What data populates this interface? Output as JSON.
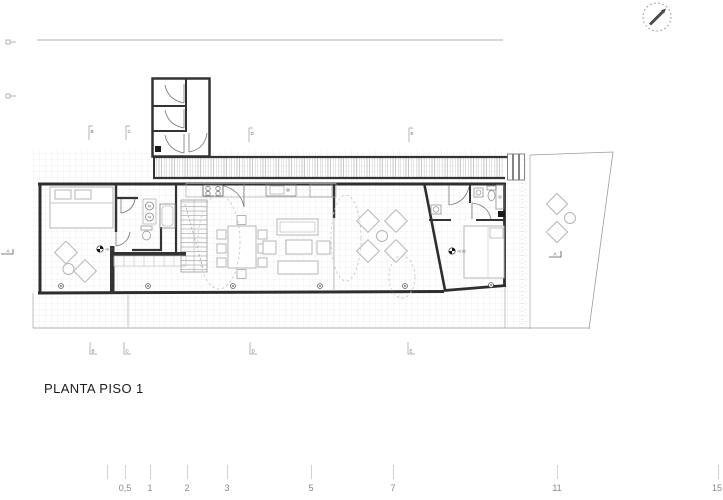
{
  "drawing": {
    "title": "PLANTA PISO 1"
  },
  "grid": {
    "top": [
      "B",
      "C",
      "D",
      "E"
    ],
    "bottom": [
      "B",
      "C",
      "D",
      "E"
    ]
  },
  "section_markers": {
    "left": "A",
    "right": "A"
  },
  "level_markers": [
    "+0.00",
    "+0.00"
  ],
  "scale_bar": {
    "labels": [
      "0,5",
      "1",
      "2",
      "3",
      "5",
      "7",
      "11",
      "15"
    ]
  },
  "colors": {
    "wall": "#2e2e2e",
    "furniture_line": "#b5b5b5",
    "site_line": "#9a9a9a",
    "text": "#1c1c1c",
    "scale_text": "#8a8a8a"
  }
}
